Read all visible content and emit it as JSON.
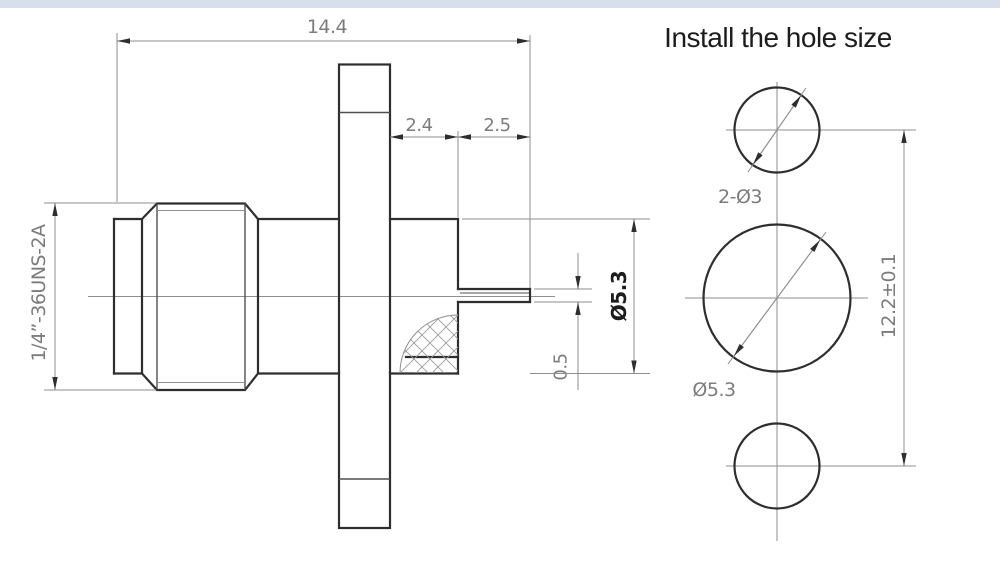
{
  "theme": {
    "bg": "#ffffff",
    "strip": "#d8dfec",
    "ink": "#1c1c1c",
    "outline": "#2e2e2e",
    "mid": "#4f4f4f",
    "thin": "#8e8e8e",
    "dim-text": "#7c7c7c",
    "hatch": "#9a9a9a"
  },
  "title": "Install the hole size",
  "side_view": {
    "labels": {
      "overall_length": "14.4",
      "flange_to_insulator": "2.4",
      "pin_protrusion": "2.5",
      "thread_spec": "1/4”-36UNS-2A",
      "pin_diameter": "0.5",
      "body_diameter": "Ø5.3"
    }
  },
  "hole_view": {
    "labels": {
      "mounting_holes": "2-Ø3",
      "center_hole": "Ø5.3",
      "hole_spacing": "12.2±0.1"
    }
  }
}
